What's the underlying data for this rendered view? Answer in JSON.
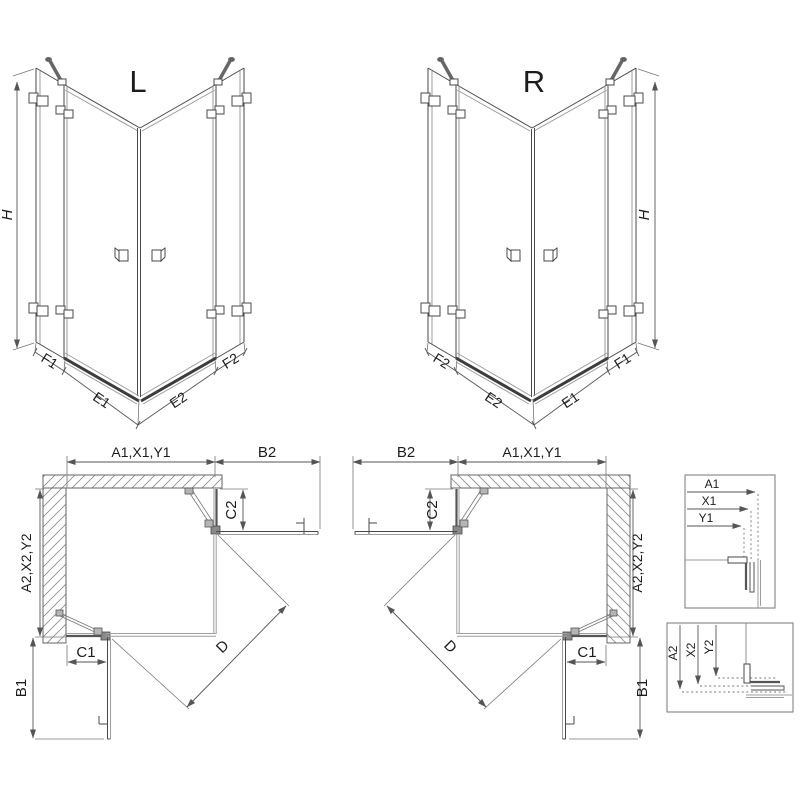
{
  "perspective_left": {
    "variant_label": "L",
    "height_label": "H",
    "bottom_labels": [
      "F1",
      "E1",
      "E2",
      "F2"
    ]
  },
  "perspective_right": {
    "variant_label": "R",
    "height_label": "H",
    "bottom_labels": [
      "F2",
      "E2",
      "E1",
      "F1"
    ]
  },
  "plan_left": {
    "width_label": "A1,X1,Y1",
    "door_open_width_label": "B2",
    "fixed_segment_side_label": "C2",
    "depth_label": "A2,X2,Y2",
    "fixed_segment_bottom_label": "C1",
    "door_open_depth_label": "B1",
    "diagonal_label": "D"
  },
  "plan_right": {
    "width_label": "A1,X1,Y1",
    "door_open_width_label": "B2",
    "fixed_segment_side_label": "C2",
    "depth_label": "A2,X2,Y2",
    "fixed_segment_bottom_label": "C1",
    "door_open_depth_label": "B1",
    "diagonal_label": "D"
  },
  "detail_width": {
    "labels": [
      "A1",
      "X1",
      "Y1"
    ]
  },
  "detail_depth": {
    "labels": [
      "A2",
      "X2",
      "Y2"
    ]
  },
  "colors": {
    "line_dark": "#4a4a4a",
    "line_light": "#9e9e9e",
    "dimension": "#555555",
    "text": "#1c1c1c",
    "background": "#ffffff"
  }
}
